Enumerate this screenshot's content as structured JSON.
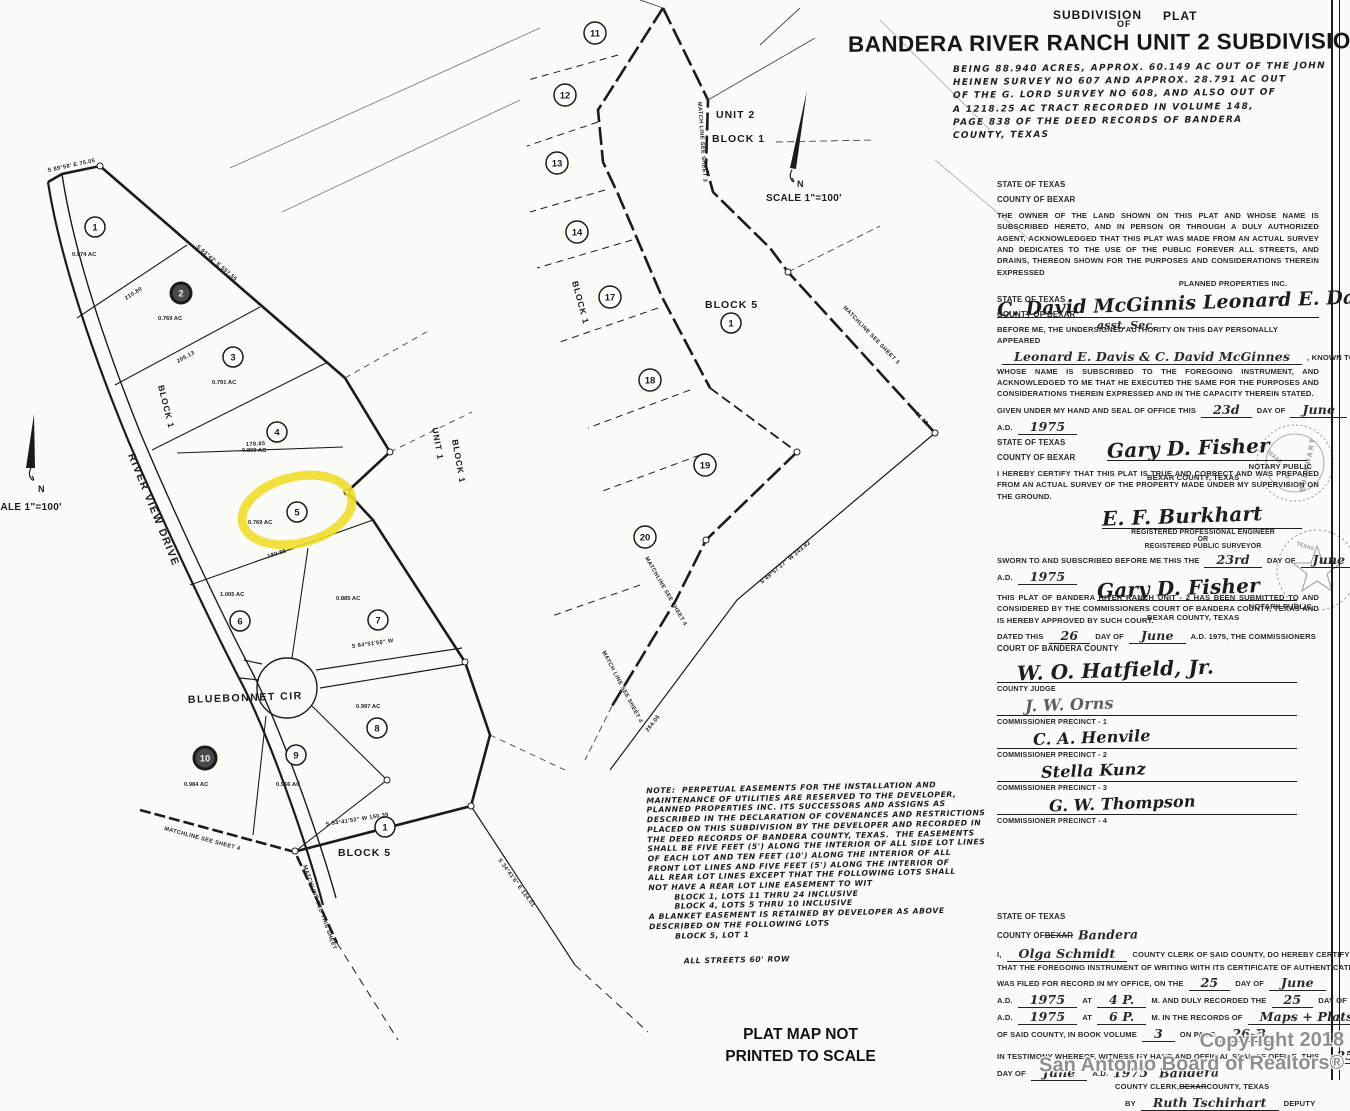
{
  "page": {
    "watermark1": "Copyright 2018",
    "watermark2": "San Antonio Board of Realtors®",
    "footer1": "PLAT MAP NOT",
    "footer2": "PRINTED TO SCALE"
  },
  "title_block": {
    "kicker1": "SUBDIVISION",
    "kicker2": "PLAT",
    "kicker3": "OF",
    "title": "BANDERA RIVER RANCH UNIT 2 SUBDIVISION",
    "desc": [
      "BEING 88.940 ACRES, APPROX. 60.149 AC OUT OF THE JOHN",
      "HEINEN SURVEY NO 607 AND APPROX. 28.791 AC OUT",
      "OF THE G. LORD SURVEY NO 608, AND ALSO OUT OF",
      "A 1218.25 AC TRACT RECORDED IN VOLUME 148,",
      "PAGE 838 OF THE DEED RECORDS OF BANDERA",
      "COUNTY, TEXAS"
    ]
  },
  "legal": {
    "owner": {
      "state": "STATE OF TEXAS",
      "county": "COUNTY OF BEXAR",
      "body": "THE OWNER OF THE LAND SHOWN ON THIS PLAT AND WHOSE NAME IS SUBSCRIBED HERETO, AND IN PERSON OR THROUGH A DULY AUTHORIZED AGENT, ACKNOWLEDGED THAT THIS PLAT WAS MADE FROM AN ACTUAL SURVEY AND DEDICATES TO THE USE OF THE PUBLIC FOREVER ALL STREETS, AND DRAINS, THEREON SHOWN FOR THE PURPOSES AND CONSIDERATIONS THEREIN EXPRESSED",
      "company": "PLANNED PROPERTIES INC.",
      "sig": "C. David McGinnis   Leonard E. Davis, Pres.",
      "sig_sub": "asst. Sec."
    },
    "notary": {
      "state": "STATE OF TEXAS",
      "county": "COUNTY OF BEXAR",
      "intro": "BEFORE ME, THE UNDERSIGNED AUTHORITY ON THIS DAY PERSONALLY APPEARED",
      "names": [
        {
          "t": "Leonard E. Davis & C. David McGinnes",
          "s": "hu"
        },
        {
          "t": ", KNOWN TO ME TO BE THE PERSON",
          "s": "p"
        }
      ],
      "body2": "WHOSE NAME IS SUBSCRIBED TO THE FOREGOING INSTRUMENT, AND ACKNOWLEDGED TO ME THAT HE EXECUTED THE SAME FOR THE PURPOSES AND CONSIDERATIONS THEREIN EXPRESSED AND IN THE CAPACITY THEREIN STATED.",
      "given": [
        {
          "t": "GIVEN UNDER MY HAND AND SEAL OF OFFICE THIS",
          "s": "p"
        },
        {
          "t": "23d",
          "s": "hu"
        },
        {
          "t": "DAY OF",
          "s": "p"
        },
        {
          "t": "June",
          "s": "hu"
        }
      ],
      "ad": [
        {
          "t": "A.D.",
          "s": "p"
        },
        {
          "t": "1975",
          "s": "hu"
        }
      ],
      "sig": "Gary D. Fisher",
      "t1": "NOTARY PUBLIC",
      "t2": "BEXAR COUNTY, TEXAS"
    },
    "surveyor": {
      "state": "STATE OF TEXAS",
      "county": "COUNTY OF BEXAR",
      "body": "I HEREBY CERTIFY THAT THIS PLAT IS TRUE AND CORRECT AND WAS PREPARED FROM AN ACTUAL SURVEY OF THE PROPERTY MADE UNDER MY SUPERVISION ON THE GROUND.",
      "sig": "E. F. Burkhart",
      "cred1": "REGISTERED PROFESSIONAL ENGINEER",
      "cred2": "OR",
      "cred3": "REGISTERED PUBLIC SURVEYOR",
      "sworn": [
        {
          "t": "SWORN TO AND SUBSCRIBED BEFORE ME THIS THE",
          "s": "p"
        },
        {
          "t": "23rd",
          "s": "hu"
        },
        {
          "t": "DAY OF",
          "s": "p"
        },
        {
          "t": "June",
          "s": "hu"
        }
      ],
      "ad": [
        {
          "t": "A.D.",
          "s": "p"
        },
        {
          "t": "1975",
          "s": "hu"
        }
      ],
      "sig2": "Gary D. Fisher",
      "t1": "NOTARY PUBLIC",
      "t2": "BEXAR COUNTY, TEXAS",
      "seal1": "E. F. BURKHART",
      "seal2": "TEXAS"
    },
    "court": {
      "body": "THIS PLAT OF BANDERA RIVER RANCH UNIT - 2 HAS BEEN SUBMITTED TO AND CONSIDERED BY THE COMMISSIONERS COURT OF BANDERA COUNTY, TEXAS AND IS HEREBY APPROVED BY SUCH COURT.",
      "dated": [
        {
          "t": "DATED THIS",
          "s": "p"
        },
        {
          "t": "26",
          "s": "hu"
        },
        {
          "t": "DAY OF",
          "s": "p"
        },
        {
          "t": "June",
          "s": "hu"
        },
        {
          "t": "A.D. 1975, THE COMMISSIONERS",
          "s": "p"
        }
      ],
      "line2": "COURT OF BANDERA COUNTY",
      "rows": [
        {
          "sig": "W. O. Hatfield, Jr.",
          "label": "COUNTY JUDGE"
        },
        {
          "sig": "J. W. Orns",
          "label": "COMMISSIONER PRECINCT - 1"
        },
        {
          "sig": "C. A. Henvile",
          "label": "COMMISSIONER PRECINCT - 2"
        },
        {
          "sig": "Stella Kunz",
          "label": "COMMISSIONER PRECINCT - 3"
        },
        {
          "sig": "G. W. Thompson",
          "label": "COMMISSIONER PRECINCT - 4"
        }
      ]
    },
    "clerk": {
      "lines": [
        [
          {
            "t": "STATE OF TEXAS",
            "s": "p"
          }
        ],
        [
          {
            "t": "COUNTY OF",
            "s": "p"
          },
          {
            "t": "BEXAR",
            "s": "ps"
          },
          {
            "t": "Bandera",
            "s": "h"
          }
        ],
        [
          {
            "t": "I,",
            "s": "p"
          },
          {
            "t": "Olga Schmidt",
            "s": "hu"
          },
          {
            "t": "COUNTY CLERK OF SAID COUNTY, DO HEREBY CERTIFY",
            "s": "p"
          }
        ],
        [
          {
            "t": "THAT THE FOREGOING INSTRUMENT OF WRITING WITH ITS CERTIFICATE OF AUTHENTICATION",
            "s": "p"
          }
        ],
        [
          {
            "t": "WAS FILED FOR RECORD IN MY OFFICE, ON THE",
            "s": "p"
          },
          {
            "t": "25",
            "s": "hu"
          },
          {
            "t": "DAY OF",
            "s": "p"
          },
          {
            "t": "June",
            "s": "hu"
          }
        ],
        [
          {
            "t": "A.D.",
            "s": "p"
          },
          {
            "t": "1975",
            "s": "hu"
          },
          {
            "t": "AT",
            "s": "p"
          },
          {
            "t": "4 P.",
            "s": "hu"
          },
          {
            "t": "M. AND DULY RECORDED THE",
            "s": "p"
          },
          {
            "t": "25",
            "s": "hu"
          },
          {
            "t": "DAY OF",
            "s": "p"
          },
          {
            "t": "June",
            "s": "hu"
          }
        ],
        [
          {
            "t": "A.D.",
            "s": "p"
          },
          {
            "t": "1975",
            "s": "hu"
          },
          {
            "t": "AT",
            "s": "p"
          },
          {
            "t": "6 P.",
            "s": "hu"
          },
          {
            "t": "M. IN THE RECORDS OF",
            "s": "p"
          },
          {
            "t": "Maps + Plats",
            "s": "hu"
          }
        ],
        [
          {
            "t": "OF SAID COUNTY, IN BOOK VOLUME",
            "s": "p"
          },
          {
            "t": "3",
            "s": "hu"
          },
          {
            "t": "ON PAGE",
            "s": "p"
          },
          {
            "t": "26-B",
            "s": "hu"
          }
        ],
        [
          {
            "t": "IN TESTIMONY WHEREOF, WITNESS MY HAND AND OFFICIAL SEAL OF OFFICE, THIS",
            "s": "p"
          },
          {
            "t": "25",
            "s": "hu"
          }
        ],
        [
          {
            "t": "DAY OF",
            "s": "p"
          },
          {
            "t": "June",
            "s": "hu"
          },
          {
            "t": "A.D.",
            "s": "p"
          },
          {
            "t": "1975",
            "s": "h"
          },
          {
            "t": "Bandera",
            "s": "h"
          }
        ],
        [
          {
            "t": "COUNTY CLERK,",
            "s": "p"
          },
          {
            "t": "BEXAR",
            "s": "ps"
          },
          {
            "t": "COUNTY, TEXAS",
            "s": "p"
          }
        ],
        [
          {
            "t": "BY",
            "s": "p"
          },
          {
            "t": "Ruth Tschirhart",
            "s": "hu"
          },
          {
            "t": "DEPUTY",
            "s": "p"
          }
        ]
      ]
    }
  },
  "note": {
    "lines": [
      "NOTE:  PERPETUAL EASEMENTS FOR THE INSTALLATION AND",
      "MAINTENANCE OF UTILITIES ARE RESERVED TO THE DEVELOPER,",
      "PLANNED PROPERTIES INC. ITS SUCCESSORS AND ASSIGNS AS",
      "DESCRIBED IN THE DECLARATION OF COVENANCES AND RESTRICTIONS",
      "PLACED ON THIS SUBDIVISION BY THE DEVELOPER AND RECORDED IN",
      "THE DEED RECORDS OF BANDERA COUNTY, TEXAS.  THE EASEMENTS",
      "SHALL BE FIVE FEET (5') ALONG THE INTERIOR OF ALL SIDE LOT LINES",
      "OF EACH LOT AND TEN FEET (10') ALONG THE INTERIOR OF ALL",
      "FRONT LOT LINES AND FIVE FEET (5') ALONG THE INTERIOR OF",
      "ALL REAR LOT LINES EXCEPT THAT THE FOLLOWING LOTS SHALL",
      "NOT HAVE A REAR LOT LINE EASEMENT TO WIT",
      "        BLOCK 1, LOTS 11 THRU 24 INCLUSIVE",
      "        BLOCK 4, LOTS 5 THRU 10 INCLUSIVE",
      "A BLANKET EASEMENT IS RETAINED BY DEVELOPER AS ABOVE",
      "DESCRIBED ON THE FOLLOWING LOTS",
      "        BLOCK 5, LOT 1"
    ],
    "streets": "ALL STREETS 60' ROW"
  },
  "maps": {
    "left": {
      "highlight": {
        "x": 297,
        "y": 510,
        "rx": 56,
        "ry": 33,
        "rot": -14
      },
      "lots": [
        {
          "n": "1",
          "x": 95,
          "y": 227,
          "ac": "0.974 AC",
          "ax": 72,
          "ay": 256
        },
        {
          "n": "2",
          "x": 181,
          "y": 293,
          "ac": "0.769 AC",
          "ax": 158,
          "ay": 320,
          "dark": true
        },
        {
          "n": "3",
          "x": 233,
          "y": 357,
          "ac": "0.791 AC",
          "ax": 212,
          "ay": 384
        },
        {
          "n": "4",
          "x": 277,
          "y": 432,
          "ac": "0.809 AC",
          "ax": 242,
          "ay": 452
        },
        {
          "n": "5",
          "x": 297,
          "y": 512,
          "ac": "0.769 AC",
          "ax": 248,
          "ay": 524,
          "hi": true
        },
        {
          "n": "6",
          "x": 240,
          "y": 621,
          "ac": "1.005 AC",
          "ax": 220,
          "ay": 596
        },
        {
          "n": "7",
          "x": 378,
          "y": 620,
          "ac": "0.885 AC",
          "ax": 336,
          "ay": 600
        },
        {
          "n": "8",
          "x": 377,
          "y": 728,
          "ac": "0.997 AC",
          "ax": 356,
          "ay": 708
        },
        {
          "n": "9",
          "x": 296,
          "y": 755,
          "ac": "0.966 AC",
          "ax": 276,
          "ay": 786
        },
        {
          "n": "10",
          "x": 205,
          "y": 758,
          "ac": "0.984 AC",
          "ax": 184,
          "ay": 786,
          "dark": true
        },
        {
          "n": "1",
          "x": 385,
          "y": 827
        }
      ],
      "labels": [
        {
          "t": "BLOCK 1",
          "x": 158,
          "y": 386,
          "r": 76,
          "cls": "block-sm"
        },
        {
          "t": "BLOCK 5",
          "x": 338,
          "y": 856,
          "r": 0,
          "cls": "block"
        },
        {
          "t": "BLUEBONNET CIR",
          "x": 188,
          "y": 703,
          "r": -2,
          "cls": "road"
        },
        {
          "t": "RIVER VIEW DRIVE",
          "x": 128,
          "y": 455,
          "r": 68,
          "cls": "road"
        },
        {
          "t": "UNIT 1",
          "x": 432,
          "y": 428,
          "r": 80,
          "cls": "block-sm"
        },
        {
          "t": "BLOCK 1",
          "x": 452,
          "y": 440,
          "r": 80,
          "cls": "block-sm"
        },
        {
          "t": "N",
          "x": 38,
          "y": 492,
          "r": 0,
          "cls": "north"
        },
        {
          "t": "SCALE 1\"=100'",
          "x": -14,
          "y": 510,
          "r": 0,
          "cls": "scale"
        }
      ],
      "bearings": [
        {
          "t": "S 63°42' E   557.55",
          "x": 196,
          "y": 247,
          "r": 41
        },
        {
          "t": "210.80",
          "x": 126,
          "y": 300,
          "r": -32
        },
        {
          "t": "205.13",
          "x": 178,
          "y": 363,
          "r": -29
        },
        {
          "t": "178.85",
          "x": 246,
          "y": 446,
          "r": -3
        },
        {
          "t": "180.85",
          "x": 268,
          "y": 558,
          "r": -17
        },
        {
          "t": "S 89°58' E  75.05",
          "x": 48,
          "y": 172,
          "r": -12
        },
        {
          "t": "S 84°51'56\" W",
          "x": 352,
          "y": 648,
          "r": -8
        },
        {
          "t": "MATCHLINE SEE SHEET 4",
          "x": 164,
          "y": 830,
          "r": 15
        },
        {
          "t": "MATCHLINE SEE THIS SHEET",
          "x": 303,
          "y": 866,
          "r": 70
        },
        {
          "t": "S 54°41'52\" W  150.39",
          "x": 326,
          "y": 826,
          "r": -9
        },
        {
          "t": "S 34°41'6\" E  124.01",
          "x": 498,
          "y": 860,
          "r": 54
        }
      ]
    },
    "middle": {
      "lots": [
        {
          "n": "11",
          "x": 595,
          "y": 33
        },
        {
          "n": "12",
          "x": 565,
          "y": 95
        },
        {
          "n": "13",
          "x": 557,
          "y": 163
        },
        {
          "n": "14",
          "x": 577,
          "y": 232
        },
        {
          "n": "17",
          "x": 610,
          "y": 297
        },
        {
          "n": "18",
          "x": 650,
          "y": 380
        },
        {
          "n": "19",
          "x": 705,
          "y": 465
        },
        {
          "n": "20",
          "x": 645,
          "y": 537
        },
        {
          "n": "1",
          "x": 731,
          "y": 323
        }
      ],
      "labels": [
        {
          "t": "UNIT 2",
          "x": 716,
          "y": 118,
          "r": 0,
          "cls": "block"
        },
        {
          "t": "BLOCK 1",
          "x": 712,
          "y": 142,
          "r": 0,
          "cls": "block"
        },
        {
          "t": "BLOCK 5",
          "x": 705,
          "y": 308,
          "r": 0,
          "cls": "block"
        },
        {
          "t": "BLOCK 1",
          "x": 572,
          "y": 282,
          "r": 75,
          "cls": "block-sm"
        },
        {
          "t": "N",
          "x": 797,
          "y": 187,
          "r": 0,
          "cls": "north"
        },
        {
          "t": "SCALE 1\"=100'",
          "x": 766,
          "y": 201,
          "r": 0,
          "cls": "scale"
        }
      ],
      "bearings": [
        {
          "t": "MATCH LINE SEE SHEET 3",
          "x": 698,
          "y": 102,
          "r": 86
        },
        {
          "t": "MATCHLINE SEE SHEET 3",
          "x": 843,
          "y": 308,
          "r": 46
        },
        {
          "t": "MATCHLINE SEE SHEET 4",
          "x": 645,
          "y": 558,
          "r": 60
        },
        {
          "t": "MATCH LINE SEE SHEET 4",
          "x": 602,
          "y": 652,
          "r": 62
        },
        {
          "t": "51.68",
          "x": 915,
          "y": 414,
          "r": 46
        },
        {
          "t": "S 49°57'27\" W   243.82",
          "x": 762,
          "y": 584,
          "r": -40
        },
        {
          "t": "264.06",
          "x": 648,
          "y": 732,
          "r": -52
        }
      ]
    }
  },
  "colors": {
    "highlight": "#f0dd2a",
    "ink": "#1b1b1b",
    "paper": "#fbfbf8",
    "watermark": "#8f8f8f"
  }
}
